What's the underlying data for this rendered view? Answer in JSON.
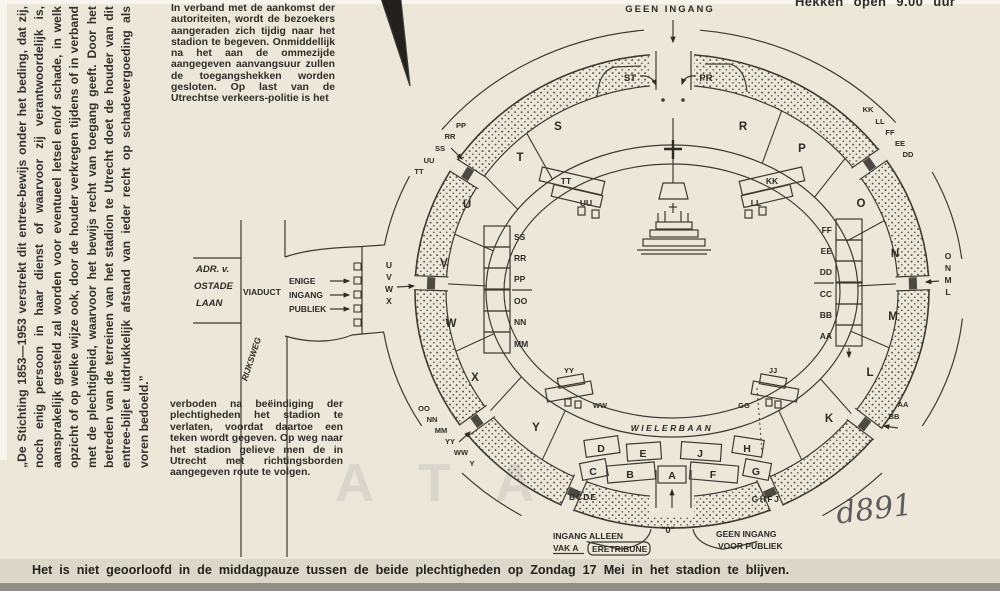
{
  "document": {
    "disclaimer_rotated": "„De Stichting 1853—1953 verstrekt dit entree-bewijs onder het beding, dat zij, noch enig persoon in haar dienst of waarvoor zij verantwoordelijk is, aansprakelijk gesteld zal worden voor eventueel letsel en/of schade, in welk opzicht of op welke wijze ook, door de houder verkregen tijdens of in verband met de plechtigheid, waarvoor het bewijs recht van toegang geeft. Door het betreden van de terreinen van het stadion te Utrecht doet de houder van dit entree-biljet uitdrukkelijk afstand van ieder recht op schadevergoeding als voren bedoeld.”",
    "notice_top": "In verband met de aankomst der autoriteiten, wordt de bezoekers aangeraden zich tijdig naar het stadion te begeven. Onmiddellijk na het aan de ommezijde aangegeven aanvangsuur zullen de toegangshekken worden gesloten. Op last van de Utrechtse verkeers-politie is het",
    "notice_bottom": "verboden na beëindiging der plechtigheden het stadion te verlaten, voordat daartoe een teken wordt gegeven. Op weg naar het stadion gelieve men de in Utrecht met richtingsborden aangegeven route te volgen.",
    "gates_note": "Hekken open 9.00 uur",
    "footer_notice": "Het is niet geoorloofd in de middagpauze tussen de beide plechtigheden op Zondag 17 Mei in het stadion te blijven.",
    "handwritten_number": "d891",
    "watermark": "ATA"
  },
  "map": {
    "roads": {
      "street_line1": "ADR. v.",
      "street_line2": "OSTADE",
      "street_line3": "LAAN",
      "viaduct": "VIADUCT",
      "rijksweg": "RIJKSWEG",
      "entrance_line1": "ENIGE",
      "entrance_line2": "INGANG",
      "entrance_line3": "PUBLIEK"
    },
    "labels": {
      "geen_ingang_top": "GEEN INGANG",
      "gate_st": "ST",
      "gate_pr": "PR",
      "wielerbaan": "WIELERBAAN",
      "gate_bcde": "BCDE",
      "gate_ghfj": "GHFJ",
      "gate_zero": "\"0\"",
      "ingang_alleen_line1": "INGANG ALLEEN",
      "vak_a": "VAK A",
      "eretribune": "ERETRIBUNE",
      "geen_ingang_bottom_line1": "GEEN INGANG",
      "geen_ingang_bottom_line2": "VOOR PUBLIEK"
    },
    "sections_left": [
      "S",
      "T",
      "U",
      "V",
      "W",
      "X",
      "Y"
    ],
    "sections_right": [
      "R",
      "P",
      "O",
      "N",
      "M",
      "L",
      "K"
    ],
    "bottom_sections_back": [
      "D",
      "E",
      "J",
      "H"
    ],
    "bottom_sections_front": [
      "C",
      "B",
      "A",
      "F",
      "G"
    ],
    "west_stand_rows": [
      "SS",
      "RR",
      "PP",
      "OO",
      "NN",
      "MM"
    ],
    "east_stand_rows": [
      "FF",
      "EE",
      "DD",
      "CC",
      "BB",
      "AA"
    ],
    "inner_stands": {
      "nw1": "TT",
      "nw2": "UU",
      "ne1": "KK",
      "ne2": "LL",
      "sw1": "YY",
      "sw2": "WW",
      "se1": "JJ",
      "se2": "GG"
    },
    "gate_stacks": {
      "northwest": [
        "PP",
        "RR",
        "SS",
        "UU",
        "TT"
      ],
      "northeast": [
        "KK",
        "LL",
        "FF",
        "EE",
        "DD"
      ],
      "west": [
        "U",
        "V",
        "W",
        "X"
      ],
      "east": [
        "O",
        "N",
        "M",
        "L"
      ],
      "southwest": [
        "OO",
        "NN",
        "MM",
        "YY",
        "WW",
        "Y"
      ],
      "southeast": [
        "AA",
        "BB"
      ]
    }
  }
}
